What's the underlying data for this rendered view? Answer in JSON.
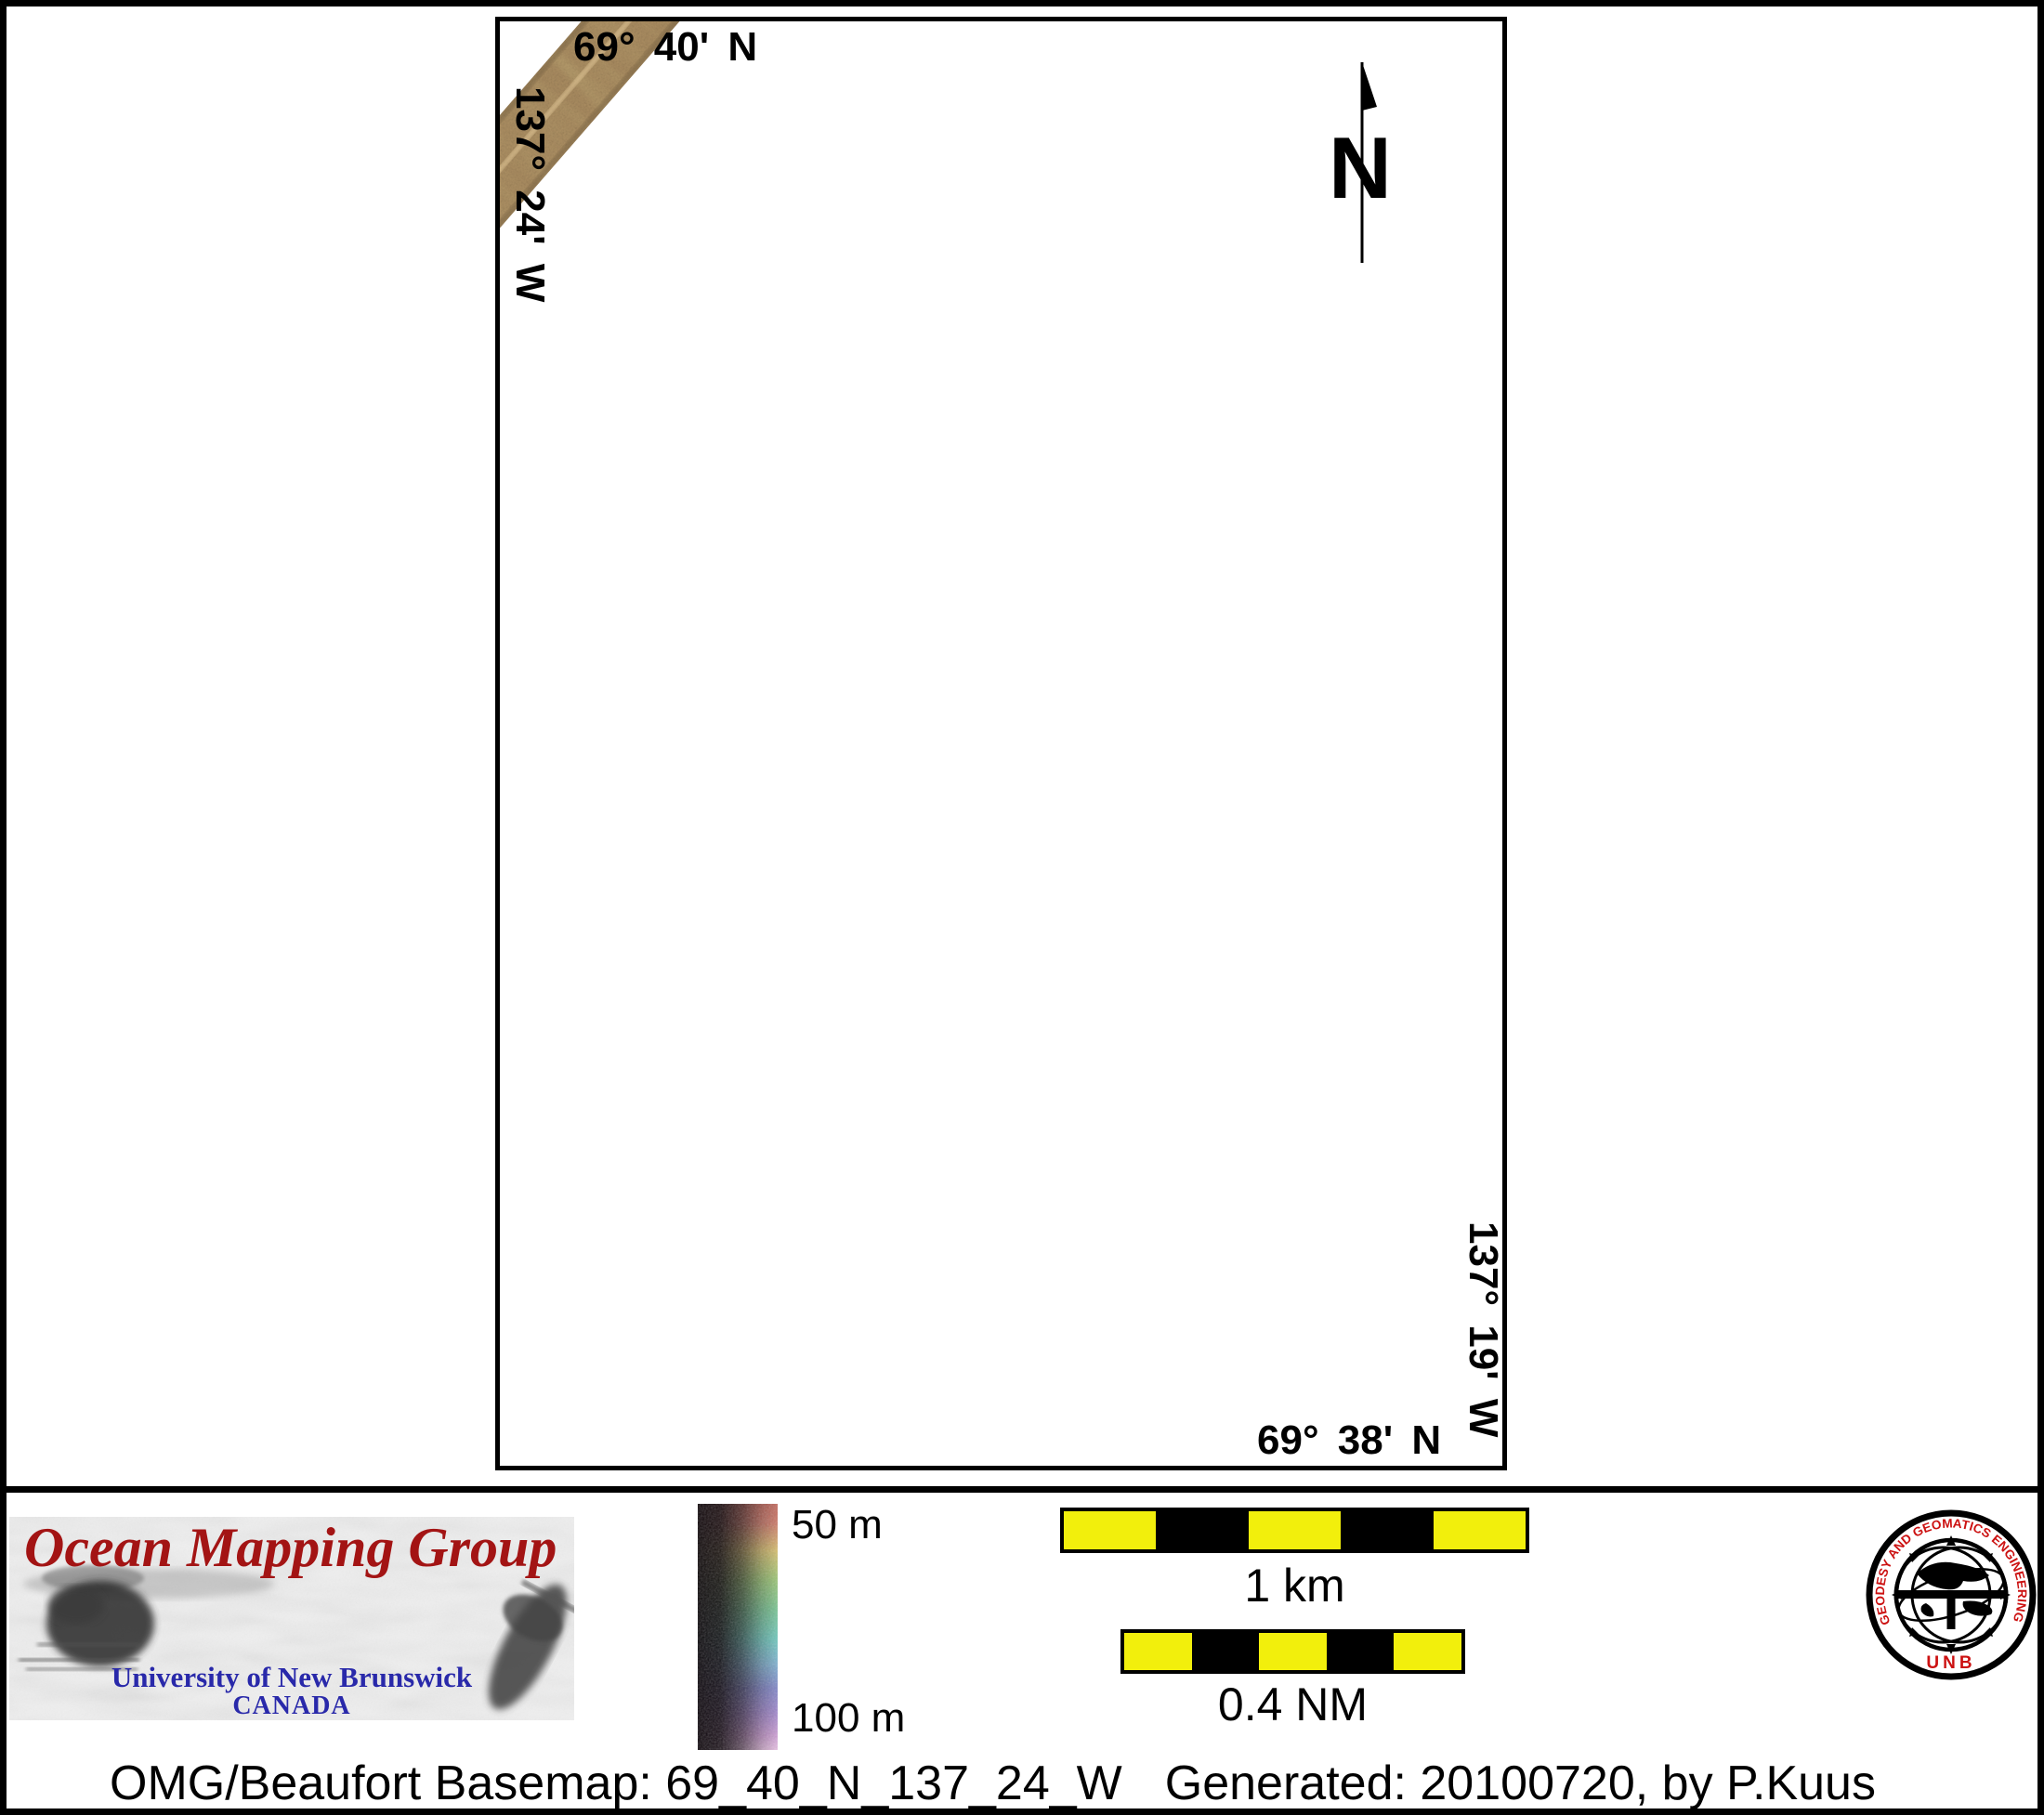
{
  "map": {
    "graticule": {
      "top": "69° 40' N",
      "left": "137° 24' W",
      "right": "137° 19' W",
      "bottom": "69° 38' N"
    },
    "north_label": "N",
    "swath": {
      "description": "multibeam-sonar-swath",
      "base_color": "#a8895e",
      "nadir_color": "#e2c898",
      "dark_speckle": "#4d3b24"
    }
  },
  "legend": {
    "omg": {
      "title": "Ocean Mapping Group",
      "university": "University of New Brunswick",
      "country": "CANADA",
      "title_color": "#a31414",
      "text_color": "#2929aa"
    },
    "colorbar": {
      "label_top": "50 m",
      "label_bottom": "100 m",
      "stops": [
        {
          "c": "#c4685c",
          "p": 0
        },
        {
          "c": "#d07b6a",
          "p": 8
        },
        {
          "c": "#d9c170",
          "p": 19
        },
        {
          "c": "#9cc877",
          "p": 31
        },
        {
          "c": "#79c795",
          "p": 43
        },
        {
          "c": "#70cbc0",
          "p": 55
        },
        {
          "c": "#7fb3d2",
          "p": 65
        },
        {
          "c": "#8288cb",
          "p": 75
        },
        {
          "c": "#a389cf",
          "p": 85
        },
        {
          "c": "#d0a0d8",
          "p": 94
        },
        {
          "c": "#edc6e9",
          "p": 100
        }
      ]
    },
    "scalebars": [
      {
        "label": "1 km",
        "segment_colors": [
          "#f2ef0c",
          "#000000",
          "#f2ef0c",
          "#000000",
          "#f2ef0c"
        ]
      },
      {
        "label": "0.4 NM",
        "segment_colors": [
          "#f2ef0c",
          "#000000",
          "#f2ef0c",
          "#000000",
          "#f2ef0c"
        ]
      }
    ],
    "seal": {
      "ring_text": "GEODESY AND GEOMATICS ENGINEERING",
      "bottom_text": "UNB",
      "text_color": "#cc1111"
    }
  },
  "caption": {
    "left": "OMG/Beaufort Basemap: 69_40_N_137_24_W",
    "right": "Generated: 20100720, by P.Kuus"
  }
}
